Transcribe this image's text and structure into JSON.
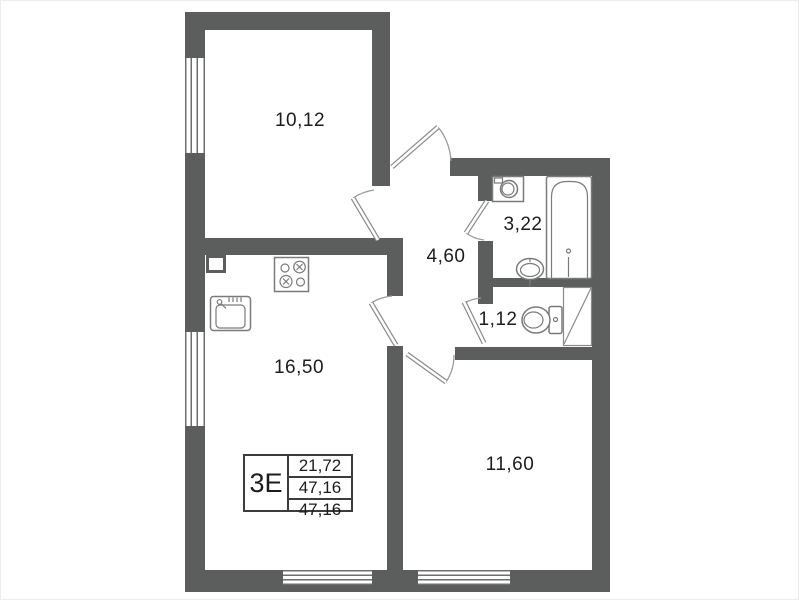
{
  "title": "apartment-floor-plan",
  "rooms": [
    {
      "id": "room-top-left",
      "area": "10,12"
    },
    {
      "id": "hallway",
      "area": "4,60"
    },
    {
      "id": "bathroom",
      "area": "3,22"
    },
    {
      "id": "wc",
      "area": "1,12"
    },
    {
      "id": "kitchen-living",
      "area": "16,50"
    },
    {
      "id": "room-bottom-right",
      "area": "11,60"
    }
  ],
  "info_box": {
    "type": "3Е",
    "values": [
      "21,72",
      "47,16",
      "47,16"
    ]
  },
  "fixtures": [
    "washing-machine",
    "bathtub",
    "wash-basin",
    "toilet",
    "vent-shaft",
    "stove",
    "kitchen-sink"
  ],
  "colors": {
    "wall": "#5c5d5d",
    "fixture_line": "#7a7a7a",
    "door_arc": "#9b9b9b",
    "text": "#1c1c1c",
    "background": "#ffffff"
  }
}
